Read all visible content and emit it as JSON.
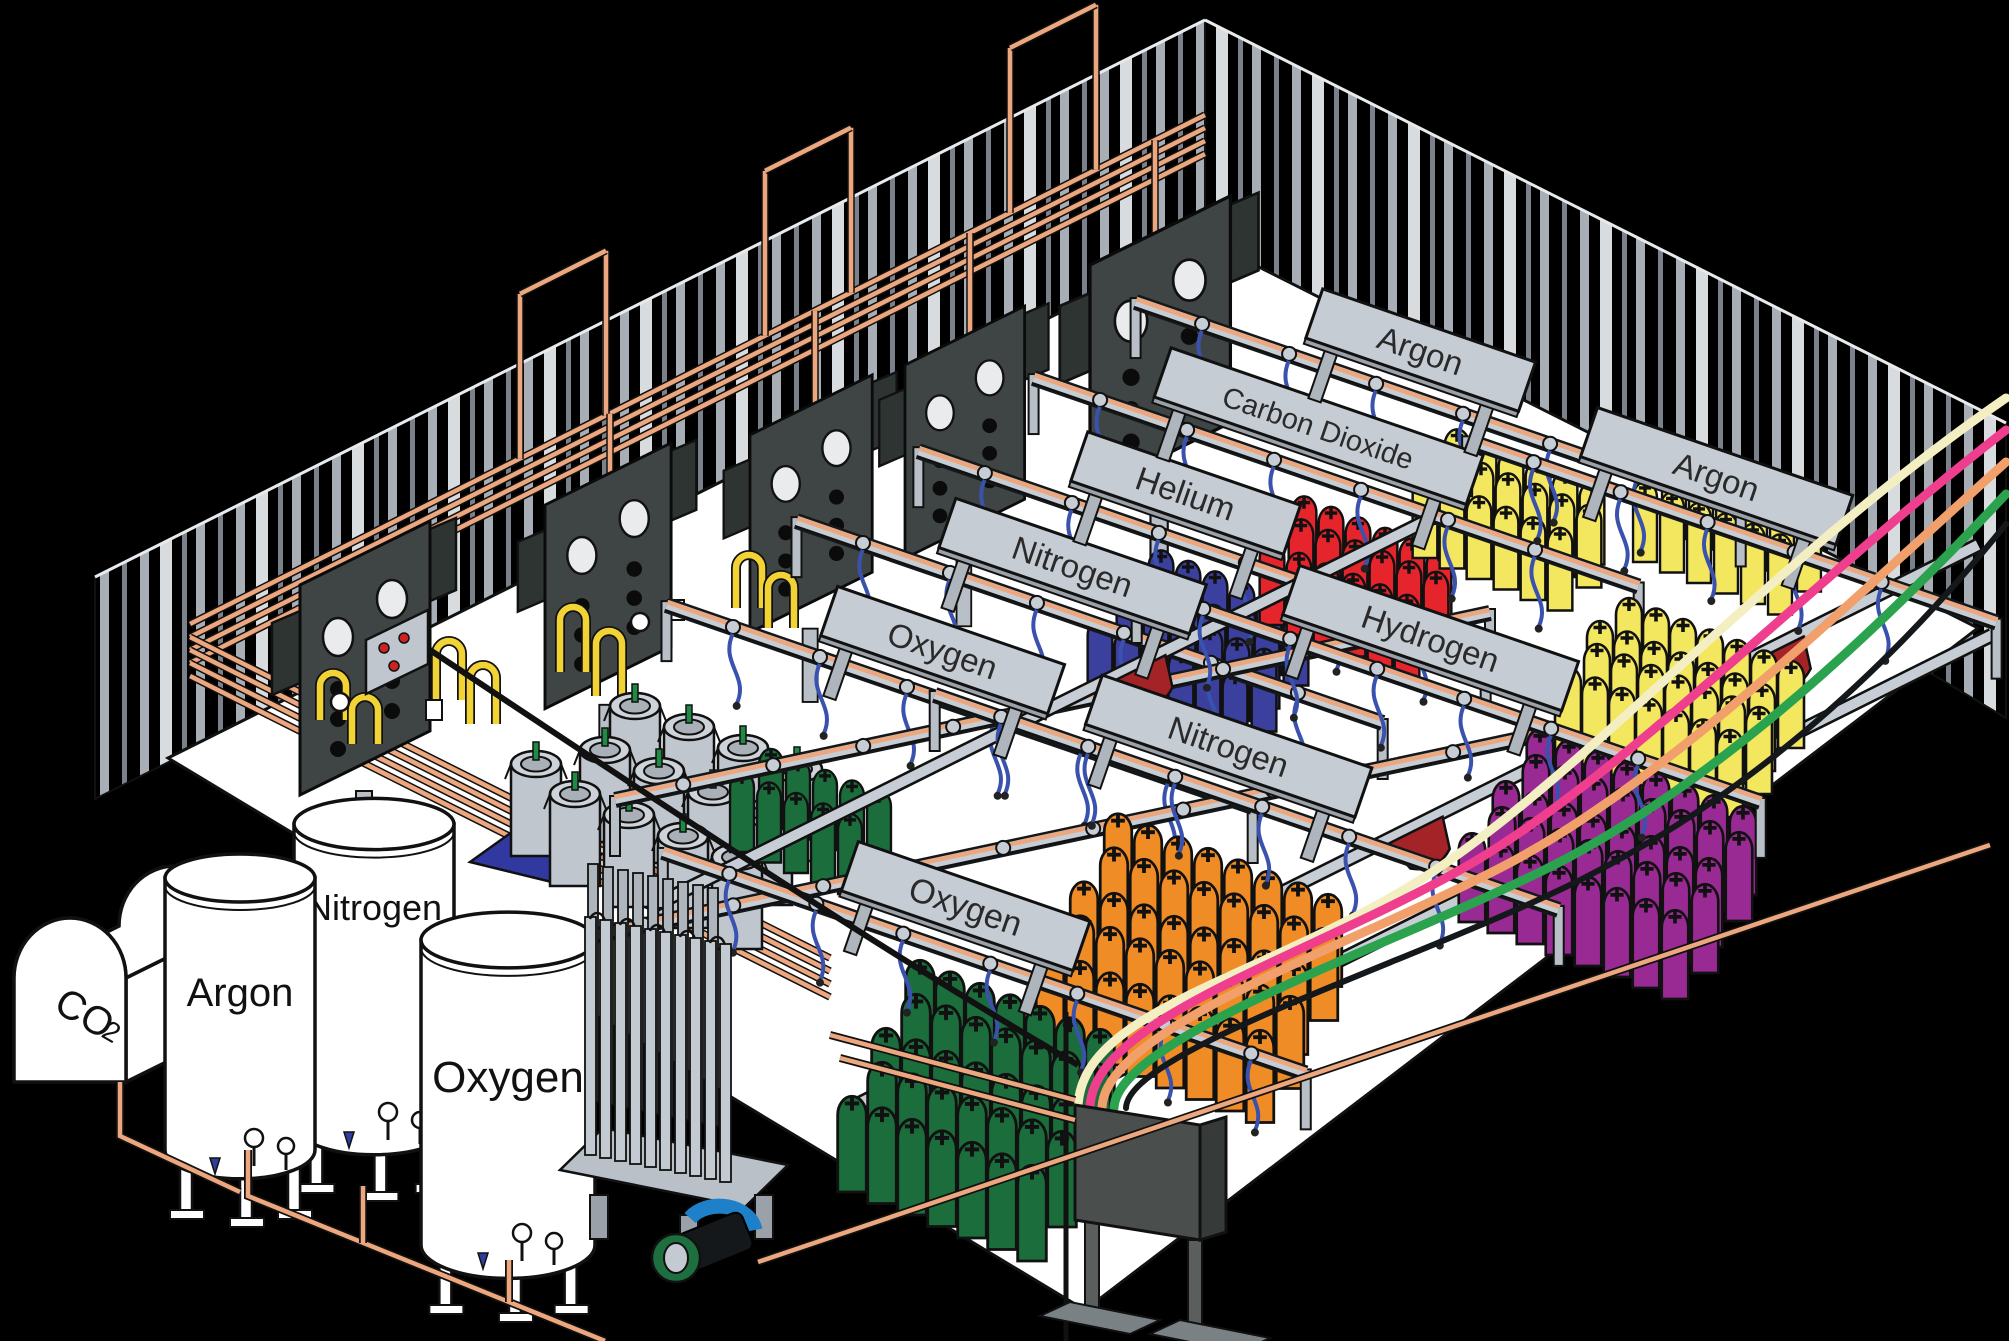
{
  "scene": {
    "title": "Industrial gas cylinder filling plant - isometric cutaway illustration"
  },
  "tanks": {
    "co2": {
      "label_main": "CO",
      "label_sub": "2"
    },
    "argon": {
      "label": "Argon"
    },
    "nitrogen": {
      "label": "Nitrogen"
    },
    "oxygen": {
      "label": "Oxygen"
    }
  },
  "signs": [
    {
      "id": "oxygen-back",
      "label": "Oxygen"
    },
    {
      "id": "nitrogen-back",
      "label": "Nitrogen"
    },
    {
      "id": "helium",
      "label": "Helium"
    },
    {
      "id": "carbon-dioxide",
      "label": "Carbon Dioxide"
    },
    {
      "id": "argon-top",
      "label": "Argon"
    },
    {
      "id": "argon-right",
      "label": "Argon"
    },
    {
      "id": "hydrogen",
      "label": "Hydrogen"
    },
    {
      "id": "nitrogen-front",
      "label": "Nitrogen"
    },
    {
      "id": "oxygen-front",
      "label": "Oxygen"
    }
  ],
  "cylinder_groups": [
    {
      "id": "oxygen-back",
      "gas": "Oxygen",
      "color": "#1B6E3C",
      "count": 10
    },
    {
      "id": "nitrogen-back",
      "gas": "Nitrogen",
      "color": "#3B3F9D",
      "count": 24
    },
    {
      "id": "helium",
      "gas": "Helium",
      "color": "#E5242C",
      "count": 18
    },
    {
      "id": "carbon-dioxide",
      "gas": "Carbon Dioxide",
      "color": "#F2E75E",
      "count": 18
    },
    {
      "id": "argon-top-row",
      "gas": "Argon",
      "color": "#F2E75E",
      "count": 12
    },
    {
      "id": "argon-right",
      "gas": "Argon",
      "color": "#F2E75E",
      "count": 28
    },
    {
      "id": "hydrogen",
      "gas": "Hydrogen",
      "color": "#992A93",
      "count": 40
    },
    {
      "id": "nitrogen-front",
      "gas": "Nitrogen",
      "color": "#F08C26",
      "count": 40
    },
    {
      "id": "oxygen-front",
      "gas": "Oxygen",
      "color": "#1B6E3C",
      "count": 35
    }
  ],
  "equipment": {
    "dewar_count": 13,
    "manifold_panel_count": 5
  },
  "colors": {
    "background": "#000000",
    "floor": "#FFFFFF",
    "outline": "#111111",
    "wall_stripe_light": "#A8AEB5",
    "wall_stripe_mid": "#7A818A",
    "wall_stripe_bright": "#D9DCDF",
    "rack_gray": "#C6CCD3",
    "panel_dark": "#3F4544",
    "copper": "#EDA77E",
    "pipe_yellow": "#F2D335",
    "hose_blue": "#3A52AE",
    "wedge_red": "#A42327",
    "pallet_blue": "#3139A0",
    "dewar_gray": "#BFC6CD",
    "valve_green": "#1F8A44",
    "valve_blue": "#2F3D9E",
    "pipe_cream": "#F4EFC2",
    "pipe_pink": "#EE3E8D",
    "pipe_salmon": "#F2A06B",
    "pipe_green": "#2AA24E",
    "pump_green": "#1E6F3F",
    "pump_blue": "#1D80C8"
  }
}
